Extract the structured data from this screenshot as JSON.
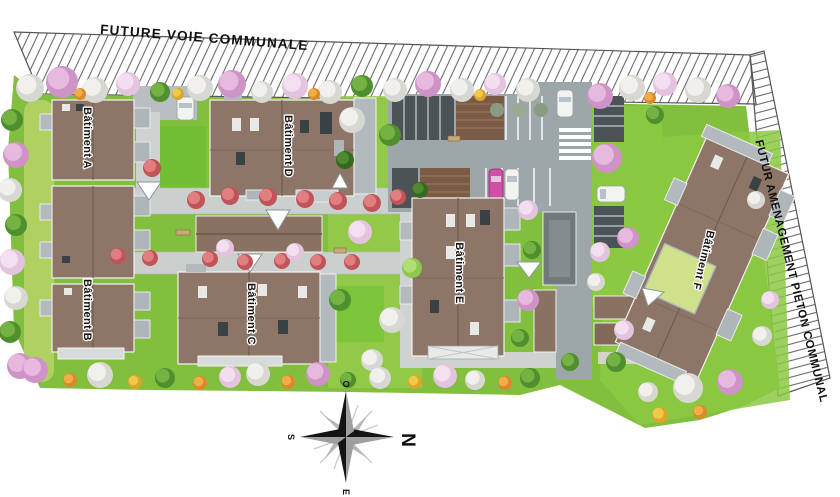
{
  "plan": {
    "roads": {
      "top_label": "FUTURE VOIE COMMUNALE",
      "right_label": "FUTUR AMENAGEMENT PIETON COMMUNAL"
    },
    "buildings": [
      {
        "id": "A",
        "label": "Bâtiment A"
      },
      {
        "id": "B",
        "label": "Bâtiment B"
      },
      {
        "id": "C",
        "label": "Bâtiment C"
      },
      {
        "id": "D",
        "label": "Bâtiment D"
      },
      {
        "id": "E",
        "label": "Bâtiment E"
      },
      {
        "id": "F",
        "label": "Bâtiment F"
      }
    ],
    "compass": {
      "north": "N",
      "east": "E",
      "south": "S",
      "west": "O"
    },
    "colors": {
      "lawn": "#82bf3e",
      "lawn_light": "#a9d25b",
      "roof_brown": "#8d7668",
      "asphalt": "#9da6a8",
      "footpath": "#cbd0cf",
      "dark_parking": "#4c5357",
      "carport": "#7a5c46",
      "balcony_gray": "#aeb6ba",
      "hatch_line": "#6a6a6a",
      "tree_pink": "#dfa9d4",
      "tree_white": "#ececea",
      "flower_red": "#d4676b",
      "green_roof_patch": "#cfe18a"
    }
  }
}
